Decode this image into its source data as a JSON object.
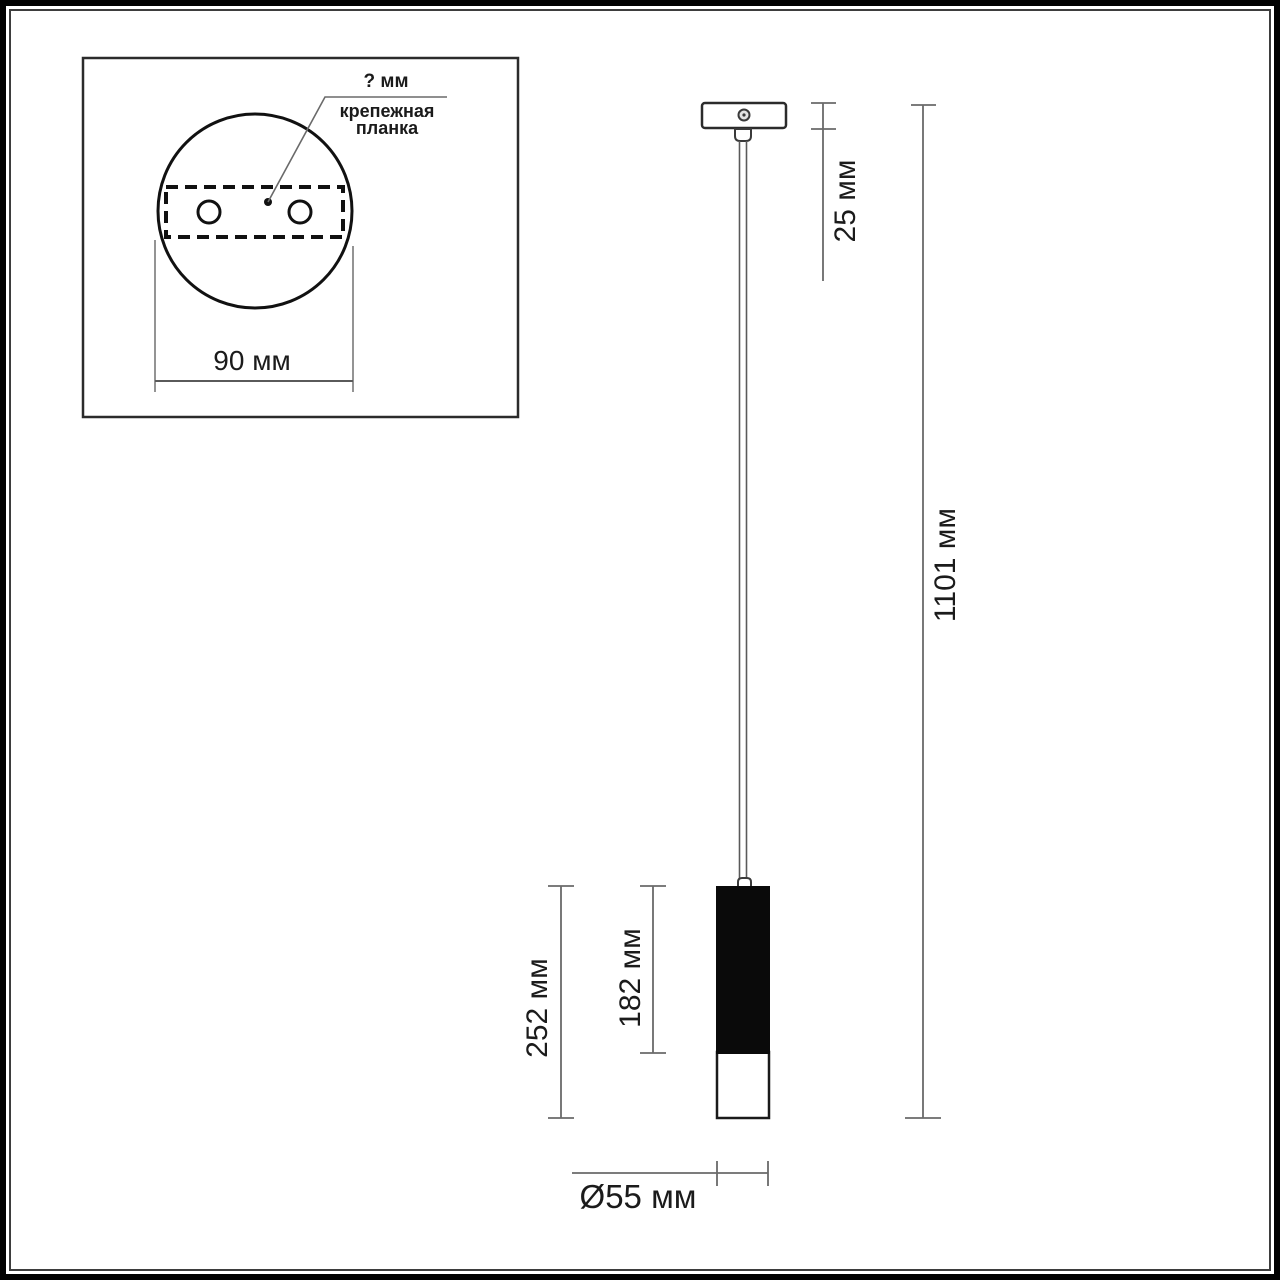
{
  "inset": {
    "unknown_dim_label": "? мм",
    "part_label_line1": "крепежная",
    "part_label_line2": "планка",
    "plate_width_label": "90 мм"
  },
  "dimensions": {
    "canopy_height": "25 мм",
    "total_height": "1101 мм",
    "shade_total_height": "252 мм",
    "shade_black_height": "182 мм",
    "shade_diameter": "Ø55 мм"
  },
  "colors": {
    "outline": "#1f1f1f",
    "dimension_line": "#6a6a6a",
    "shade_fill": "#0a0a0a",
    "frame": "#000000"
  }
}
